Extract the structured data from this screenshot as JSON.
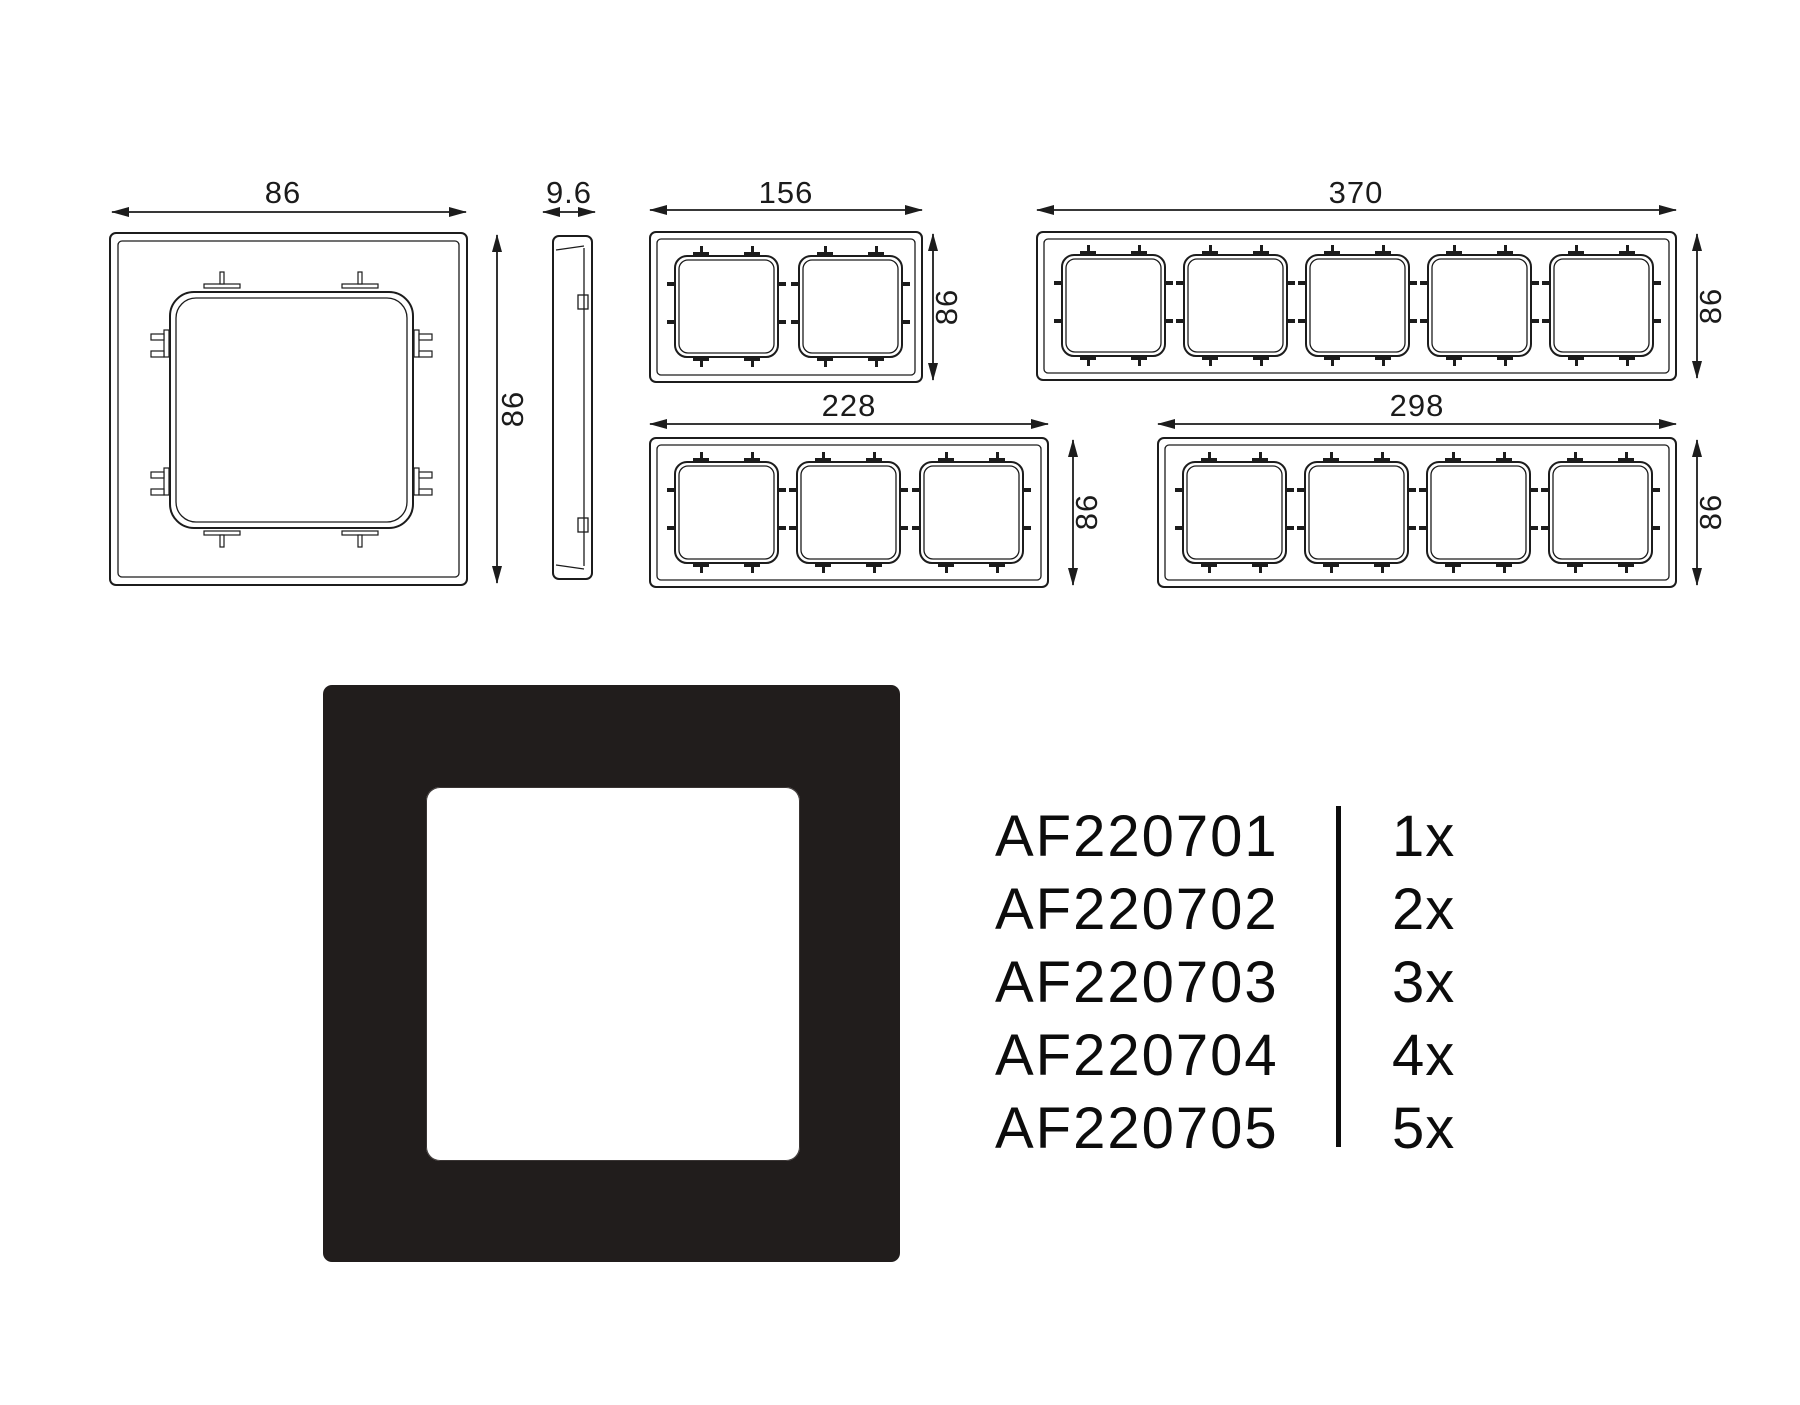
{
  "drawings": {
    "line_color": "#1c1c1c",
    "one_gang": {
      "width": "86",
      "height": "86"
    },
    "side_view": {
      "thickness": "9.6"
    },
    "two_gang": {
      "width": "156",
      "height": "86"
    },
    "five_gang": {
      "width": "370",
      "height": "86"
    },
    "three_gang": {
      "width": "228",
      "height": "86"
    },
    "four_gang": {
      "width": "298",
      "height": "86"
    }
  },
  "product": {
    "frame_color": "#211d1c"
  },
  "parts": [
    {
      "code": "AF220701",
      "qty": "1x"
    },
    {
      "code": "AF220702",
      "qty": "2x"
    },
    {
      "code": "AF220703",
      "qty": "3x"
    },
    {
      "code": "AF220704",
      "qty": "4x"
    },
    {
      "code": "AF220705",
      "qty": "5x"
    }
  ]
}
